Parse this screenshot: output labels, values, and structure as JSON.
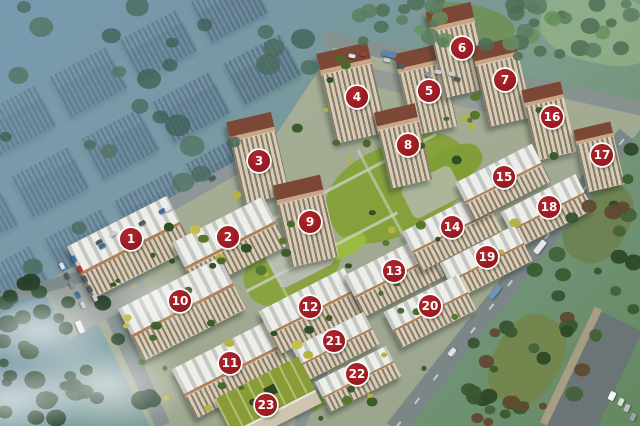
{
  "colors": {
    "marker_red": "#9b1c22",
    "marker_border": "#ffffff",
    "marker_text": "#ffffff"
  },
  "markers": [
    {
      "label": "1",
      "x": 131,
      "y": 239
    },
    {
      "label": "2",
      "x": 228,
      "y": 237
    },
    {
      "label": "3",
      "x": 259,
      "y": 161
    },
    {
      "label": "4",
      "x": 357,
      "y": 97
    },
    {
      "label": "5",
      "x": 429,
      "y": 91
    },
    {
      "label": "6",
      "x": 462,
      "y": 48
    },
    {
      "label": "7",
      "x": 505,
      "y": 80
    },
    {
      "label": "8",
      "x": 408,
      "y": 145
    },
    {
      "label": "9",
      "x": 310,
      "y": 222
    },
    {
      "label": "10",
      "x": 180,
      "y": 301
    },
    {
      "label": "11",
      "x": 230,
      "y": 363
    },
    {
      "label": "12",
      "x": 310,
      "y": 307
    },
    {
      "label": "13",
      "x": 394,
      "y": 271
    },
    {
      "label": "14",
      "x": 452,
      "y": 227
    },
    {
      "label": "15",
      "x": 504,
      "y": 177
    },
    {
      "label": "16",
      "x": 552,
      "y": 117
    },
    {
      "label": "17",
      "x": 602,
      "y": 155
    },
    {
      "label": "18",
      "x": 549,
      "y": 207
    },
    {
      "label": "19",
      "x": 487,
      "y": 257
    },
    {
      "label": "20",
      "x": 430,
      "y": 306
    },
    {
      "label": "21",
      "x": 334,
      "y": 341
    },
    {
      "label": "22",
      "x": 357,
      "y": 374
    },
    {
      "label": "23",
      "x": 266,
      "y": 405
    }
  ]
}
